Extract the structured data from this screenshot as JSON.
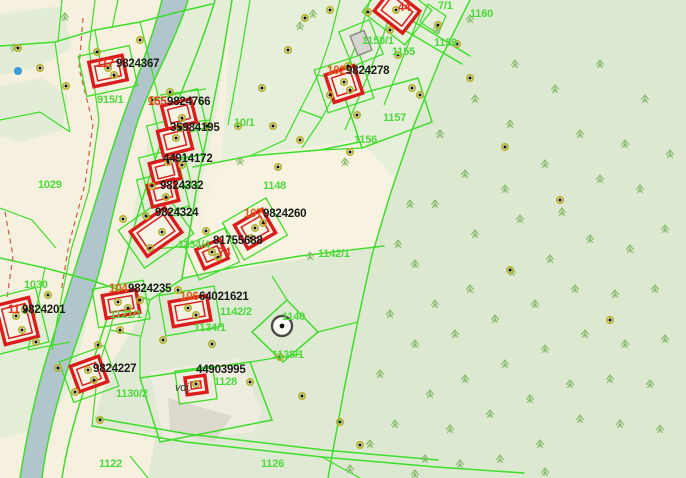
{
  "map": {
    "colors": {
      "base_cream": "#f5f1de",
      "parcel_green_light": "#e4edd6",
      "forest_sage": "#dde8d1",
      "river_blue": "#b0c5cc",
      "boundary_green": "#3fdd2b",
      "building_red": "#dc1c1c",
      "label_black": "#1c1c1c",
      "label_green": "#4cd93c",
      "label_red": "#e3301f",
      "label_orange": "#dd5f17",
      "point_ring_olive": "#b5b02a",
      "tree_green": "#84b96a",
      "dashed_path_red": "#d05c44"
    },
    "labels": [
      {
        "t": "117",
        "c": "red",
        "x": 96,
        "y": 67
      },
      {
        "t": "9824367",
        "c": "black",
        "x": 116,
        "y": 67
      },
      {
        "t": "155",
        "c": "red",
        "x": 148,
        "y": 105
      },
      {
        "t": "9824766",
        "c": "black",
        "x": 167,
        "y": 105
      },
      {
        "t": "35984195",
        "c": "black",
        "x": 170,
        "y": 131
      },
      {
        "t": "44914172",
        "c": "black",
        "x": 163,
        "y": 162
      },
      {
        "t": "9824332",
        "c": "black",
        "x": 160,
        "y": 189
      },
      {
        "t": "9824324",
        "c": "black",
        "x": 155,
        "y": 216
      },
      {
        "t": "107",
        "c": "orange",
        "x": 244,
        "y": 217
      },
      {
        "t": "9824260",
        "c": "black",
        "x": 263,
        "y": 217
      },
      {
        "t": "81755688",
        "c": "black",
        "x": 213,
        "y": 244
      },
      {
        "t": "102",
        "c": "orange",
        "x": 327,
        "y": 74
      },
      {
        "t": "9824278",
        "c": "black",
        "x": 346,
        "y": 74
      },
      {
        "t": "104",
        "c": "orange",
        "x": 109,
        "y": 292
      },
      {
        "t": "9824235",
        "c": "black",
        "x": 128,
        "y": 292
      },
      {
        "t": "11",
        "c": "red",
        "x": 8,
        "y": 313
      },
      {
        "t": "9824201",
        "c": "black",
        "x": 22,
        "y": 313
      },
      {
        "t": "9824227",
        "c": "black",
        "x": 93,
        "y": 372
      },
      {
        "t": "106",
        "c": "orange",
        "x": 180,
        "y": 300
      },
      {
        "t": "64021621",
        "c": "black",
        "x": 199,
        "y": 300
      },
      {
        "t": "44903995",
        "c": "black",
        "x": 196,
        "y": 373
      },
      {
        "t": "74",
        "c": "red",
        "x": 218,
        "y": 256
      },
      {
        "t": "44",
        "c": "red",
        "x": 398,
        "y": 11
      },
      {
        "t": "915/1",
        "c": "green",
        "x": 97,
        "y": 103
      },
      {
        "t": "1029",
        "c": "green",
        "x": 38,
        "y": 188
      },
      {
        "t": "1030",
        "c": "green",
        "x": 24,
        "y": 288
      },
      {
        "t": "1160",
        "c": "green",
        "x": 470,
        "y": 17
      },
      {
        "t": "1159",
        "c": "green",
        "x": 434,
        "y": 46
      },
      {
        "t": "7/1",
        "c": "green",
        "x": 438,
        "y": 9
      },
      {
        "t": "1150/1",
        "c": "green",
        "x": 362,
        "y": 44
      },
      {
        "t": "1155",
        "c": "green",
        "x": 392,
        "y": 55
      },
      {
        "t": "1157",
        "c": "green",
        "x": 383,
        "y": 121
      },
      {
        "t": "1156",
        "c": "green",
        "x": 354,
        "y": 143
      },
      {
        "t": "1148",
        "c": "green",
        "x": 263,
        "y": 189
      },
      {
        "t": "10/1",
        "c": "green",
        "x": 234,
        "y": 126
      },
      {
        "t": "1142/1",
        "c": "green",
        "x": 318,
        "y": 257
      },
      {
        "t": "1142/2",
        "c": "green",
        "x": 220,
        "y": 315
      },
      {
        "t": "1140",
        "c": "green",
        "x": 282,
        "y": 320
      },
      {
        "t": "1138/1",
        "c": "green",
        "x": 272,
        "y": 358
      },
      {
        "t": "1134/1",
        "c": "green",
        "x": 194,
        "y": 331
      },
      {
        "t": "1134/4",
        "c": "green",
        "x": 178,
        "y": 248
      },
      {
        "t": "1121/1",
        "c": "green",
        "x": 110,
        "y": 318
      },
      {
        "t": "1130/2",
        "c": "green",
        "x": 116,
        "y": 397
      },
      {
        "t": "1128",
        "c": "green",
        "x": 214,
        "y": 385
      },
      {
        "t": "1122",
        "c": "green",
        "x": 99,
        "y": 467
      },
      {
        "t": "1126",
        "c": "green",
        "x": 261,
        "y": 467
      },
      {
        "t": "vdj.",
        "c": "dark",
        "x": 175,
        "y": 391
      }
    ],
    "buildings": [
      {
        "cx": 108,
        "cy": 71,
        "w": 34,
        "h": 25,
        "rot": -12,
        "kind": "hatched"
      },
      {
        "cx": 179,
        "cy": 114,
        "w": 30,
        "h": 24,
        "rot": -14,
        "kind": "hatched"
      },
      {
        "cx": 175,
        "cy": 140,
        "w": 30,
        "h": 25,
        "rot": -14,
        "kind": "hatched"
      },
      {
        "cx": 165,
        "cy": 171,
        "w": 27,
        "h": 22,
        "rot": -14,
        "kind": "hatched"
      },
      {
        "cx": 163,
        "cy": 193,
        "w": 27,
        "h": 22,
        "rot": -14,
        "kind": "hatched"
      },
      {
        "cx": 156,
        "cy": 232,
        "w": 42,
        "h": 30,
        "rot": -35,
        "kind": "hatched"
      },
      {
        "cx": 212,
        "cy": 254,
        "w": 26,
        "h": 21,
        "rot": -24,
        "kind": "hatched"
      },
      {
        "cx": 255,
        "cy": 229,
        "w": 32,
        "h": 27,
        "rot": -30,
        "kind": "hatched"
      },
      {
        "cx": 397,
        "cy": 11,
        "w": 36,
        "h": 28,
        "rot": 38,
        "kind": "hatched"
      },
      {
        "cx": 344,
        "cy": 84,
        "w": 30,
        "h": 29,
        "rot": -18,
        "kind": "hatched"
      },
      {
        "cx": 17,
        "cy": 321,
        "w": 34,
        "h": 40,
        "rot": -14,
        "kind": "hatched"
      },
      {
        "cx": 121,
        "cy": 304,
        "w": 34,
        "h": 23,
        "rot": -10,
        "kind": "hatched"
      },
      {
        "cx": 89,
        "cy": 374,
        "w": 30,
        "h": 27,
        "rot": -20,
        "kind": "hatched"
      },
      {
        "cx": 190,
        "cy": 311,
        "w": 38,
        "h": 25,
        "rot": -10,
        "kind": "hatched"
      },
      {
        "cx": 196,
        "cy": 385,
        "w": 20,
        "h": 17,
        "rot": -8,
        "kind": "hatched"
      },
      {
        "cx": 361,
        "cy": 43,
        "w": 15,
        "h": 21,
        "rot": -22,
        "kind": "gray"
      }
    ],
    "points": [
      [
        18,
        48
      ],
      [
        40,
        68
      ],
      [
        66,
        86
      ],
      [
        97,
        52
      ],
      [
        140,
        40
      ],
      [
        108,
        68
      ],
      [
        114,
        75
      ],
      [
        152,
        100
      ],
      [
        170,
        92
      ],
      [
        182,
        118
      ],
      [
        176,
        138
      ],
      [
        168,
        162
      ],
      [
        182,
        165
      ],
      [
        152,
        186
      ],
      [
        166,
        197
      ],
      [
        146,
        216
      ],
      [
        162,
        232
      ],
      [
        150,
        248
      ],
      [
        123,
        219
      ],
      [
        206,
        231
      ],
      [
        212,
        252
      ],
      [
        218,
        257
      ],
      [
        251,
        238
      ],
      [
        263,
        223
      ],
      [
        255,
        228
      ],
      [
        273,
        126
      ],
      [
        238,
        126
      ],
      [
        207,
        126
      ],
      [
        180,
        128
      ],
      [
        344,
        82
      ],
      [
        350,
        90
      ],
      [
        348,
        66
      ],
      [
        330,
        95
      ],
      [
        357,
        115
      ],
      [
        300,
        140
      ],
      [
        278,
        167
      ],
      [
        398,
        55
      ],
      [
        412,
        88
      ],
      [
        438,
        25
      ],
      [
        457,
        44
      ],
      [
        470,
        78
      ],
      [
        505,
        147
      ],
      [
        420,
        95
      ],
      [
        350,
        152
      ],
      [
        396,
        10
      ],
      [
        178,
        290
      ],
      [
        140,
        300
      ],
      [
        120,
        330
      ],
      [
        98,
        345
      ],
      [
        163,
        340
      ],
      [
        188,
        308
      ],
      [
        196,
        315
      ],
      [
        212,
        344
      ],
      [
        250,
        382
      ],
      [
        280,
        357
      ],
      [
        302,
        396
      ],
      [
        340,
        422
      ],
      [
        360,
        445
      ],
      [
        100,
        420
      ],
      [
        75,
        392
      ],
      [
        58,
        368
      ],
      [
        36,
        342
      ],
      [
        25,
        310
      ],
      [
        48,
        295
      ],
      [
        16,
        316
      ],
      [
        22,
        330
      ],
      [
        118,
        302
      ],
      [
        128,
        308
      ],
      [
        88,
        370
      ],
      [
        94,
        380
      ],
      [
        196,
        384
      ],
      [
        305,
        18
      ],
      [
        288,
        50
      ],
      [
        262,
        88
      ],
      [
        330,
        10
      ],
      [
        368,
        12
      ],
      [
        390,
        30
      ],
      [
        560,
        200
      ],
      [
        610,
        320
      ],
      [
        510,
        270
      ]
    ],
    "trees": [
      [
        437,
        25
      ],
      [
        470,
        15
      ],
      [
        515,
        60
      ],
      [
        475,
        95
      ],
      [
        440,
        130
      ],
      [
        510,
        120
      ],
      [
        555,
        85
      ],
      [
        600,
        60
      ],
      [
        645,
        95
      ],
      [
        670,
        150
      ],
      [
        625,
        140
      ],
      [
        580,
        130
      ],
      [
        545,
        160
      ],
      [
        505,
        185
      ],
      [
        465,
        170
      ],
      [
        435,
        200
      ],
      [
        475,
        230
      ],
      [
        520,
        215
      ],
      [
        562,
        208
      ],
      [
        600,
        175
      ],
      [
        640,
        185
      ],
      [
        665,
        225
      ],
      [
        630,
        245
      ],
      [
        590,
        235
      ],
      [
        550,
        255
      ],
      [
        512,
        268
      ],
      [
        470,
        285
      ],
      [
        435,
        300
      ],
      [
        415,
        260
      ],
      [
        455,
        330
      ],
      [
        495,
        315
      ],
      [
        535,
        300
      ],
      [
        575,
        285
      ],
      [
        615,
        290
      ],
      [
        655,
        285
      ],
      [
        665,
        335
      ],
      [
        625,
        340
      ],
      [
        585,
        330
      ],
      [
        545,
        345
      ],
      [
        505,
        360
      ],
      [
        465,
        375
      ],
      [
        430,
        390
      ],
      [
        415,
        340
      ],
      [
        450,
        425
      ],
      [
        490,
        410
      ],
      [
        530,
        395
      ],
      [
        570,
        380
      ],
      [
        610,
        375
      ],
      [
        650,
        380
      ],
      [
        660,
        425
      ],
      [
        620,
        420
      ],
      [
        580,
        415
      ],
      [
        540,
        440
      ],
      [
        500,
        455
      ],
      [
        460,
        460
      ],
      [
        425,
        455
      ],
      [
        395,
        420
      ],
      [
        380,
        370
      ],
      [
        390,
        310
      ],
      [
        370,
        440
      ],
      [
        350,
        465
      ],
      [
        415,
        470
      ],
      [
        545,
        468
      ],
      [
        300,
        22
      ],
      [
        313,
        10
      ],
      [
        65,
        13
      ],
      [
        14,
        44
      ],
      [
        345,
        158
      ],
      [
        310,
        252
      ],
      [
        240,
        157
      ],
      [
        410,
        200
      ],
      [
        398,
        240
      ]
    ],
    "features": {
      "well_marker": {
        "x": 282,
        "y": 326
      },
      "water_point_blue": {
        "x": 18,
        "y": 71
      }
    }
  }
}
